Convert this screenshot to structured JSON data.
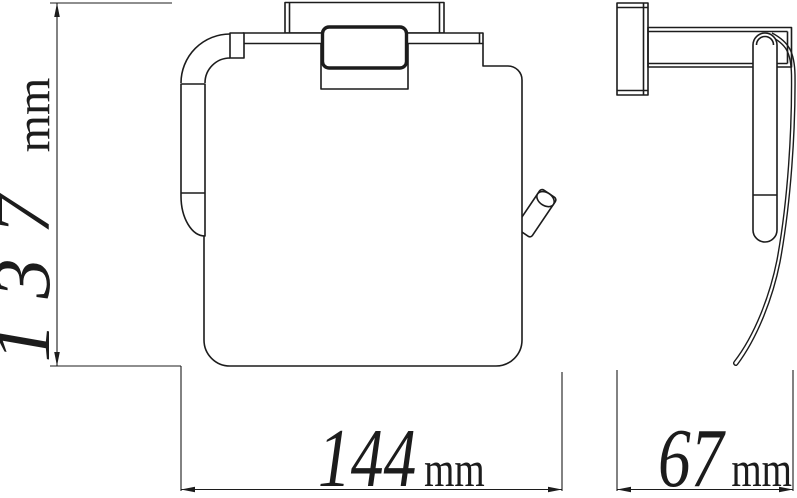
{
  "drawing": {
    "views": {
      "front": "front-view",
      "side": "side-view"
    }
  },
  "dimensions": {
    "height": {
      "value": "137",
      "unit": "mm"
    },
    "width": {
      "value": "144",
      "unit": "mm"
    },
    "depth": {
      "value": "67",
      "unit": "mm"
    }
  },
  "colors": {
    "line": "#1c1c1c",
    "background": "#ffffff"
  }
}
